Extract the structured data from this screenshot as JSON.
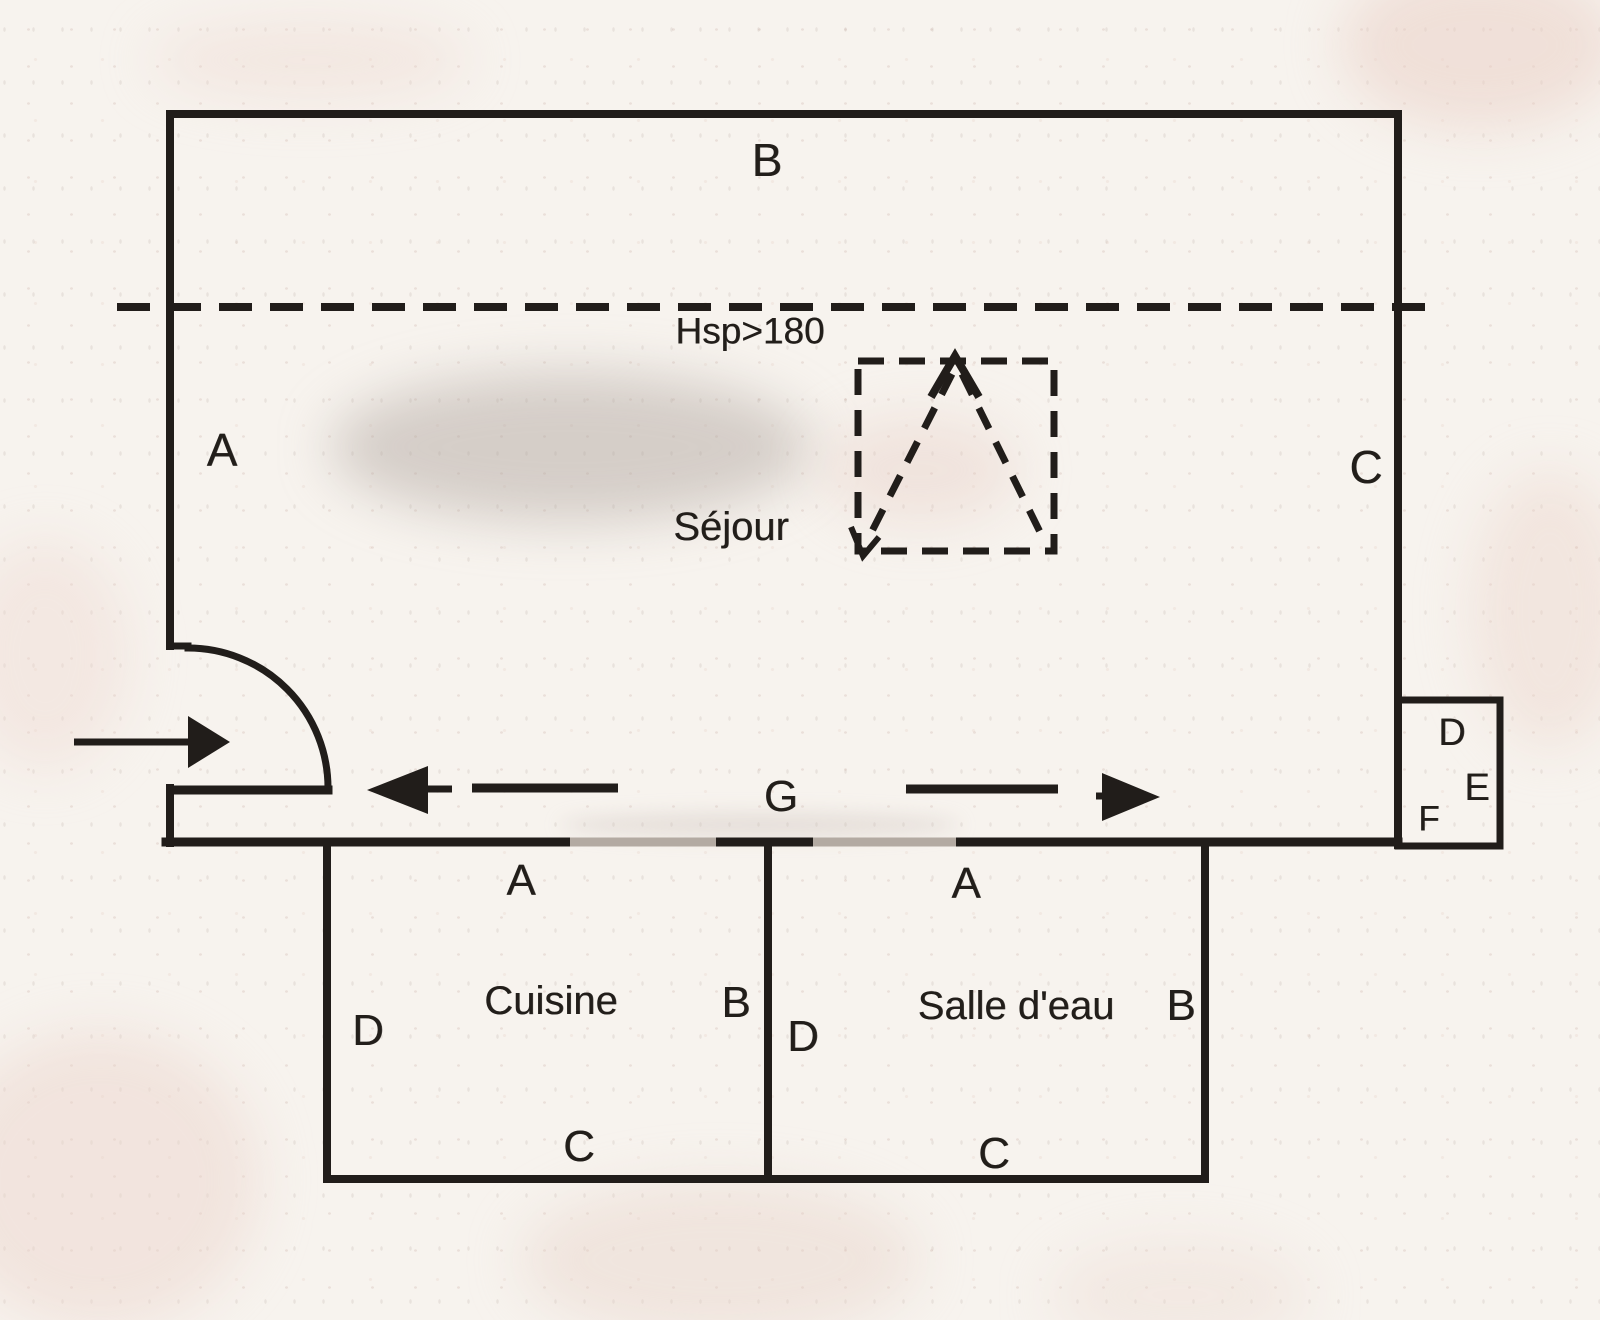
{
  "document": {
    "kind": "scanned floor plan sketch",
    "colors": {
      "ink": "#211d1a",
      "paper": "#f7f3ee",
      "faded_wall_opening": "#b3aaa2"
    }
  },
  "sejour": {
    "name": "Séjour",
    "wall_label_left": "A",
    "wall_label_top": "B",
    "wall_label_right": "C",
    "ceiling_height_note": "Hsp>180",
    "passage_label": "G"
  },
  "annex_box": {
    "label_d": "D",
    "label_e": "E",
    "label_f": "F"
  },
  "cuisine": {
    "name": "Cuisine",
    "wall_label_top": "A",
    "wall_label_right": "B",
    "wall_label_bottom": "C",
    "wall_label_left": "D"
  },
  "salle_deau": {
    "name": "Salle d'eau",
    "wall_label_top": "A",
    "wall_label_right": "B",
    "wall_label_bottom": "C",
    "wall_label_left": "D"
  }
}
